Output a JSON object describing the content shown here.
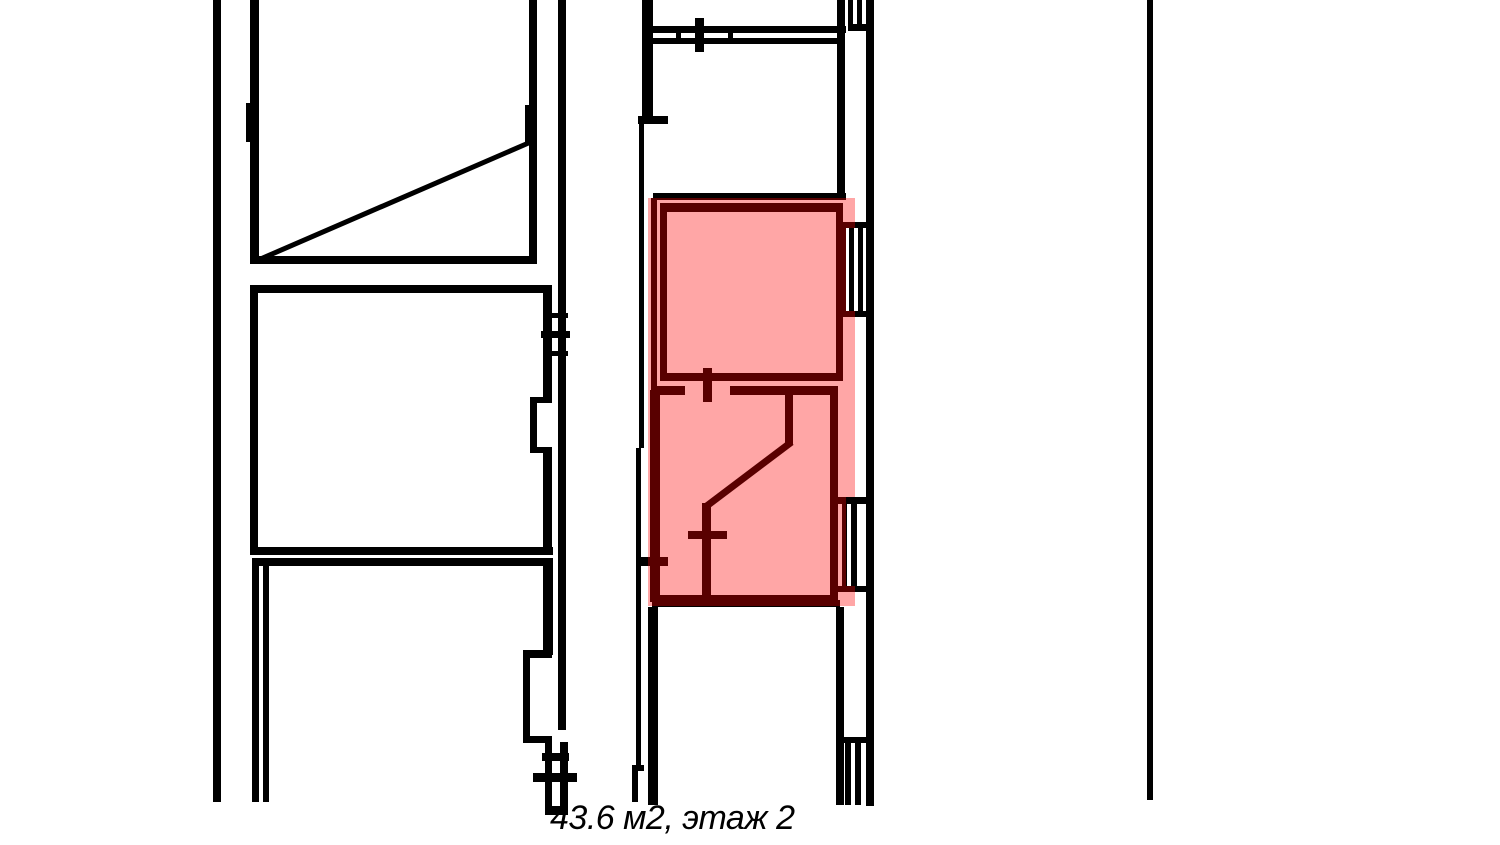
{
  "page": {
    "background": "#ffffff",
    "type_hint": "apartment floor plan with selected unit highlighted"
  },
  "caption": {
    "text": "43.6 м2, этаж 2",
    "area_m2": "43.6",
    "floor": "2"
  },
  "highlight": {
    "style": "background:rgba(255,0,0,0.35)",
    "fill": "rgba(255,0,0,0.35)",
    "tint_over_white": "#ffa6a6",
    "tint_over_walls": "#590000"
  },
  "colors": {
    "walls": "#000000",
    "background": "#ffffff"
  }
}
